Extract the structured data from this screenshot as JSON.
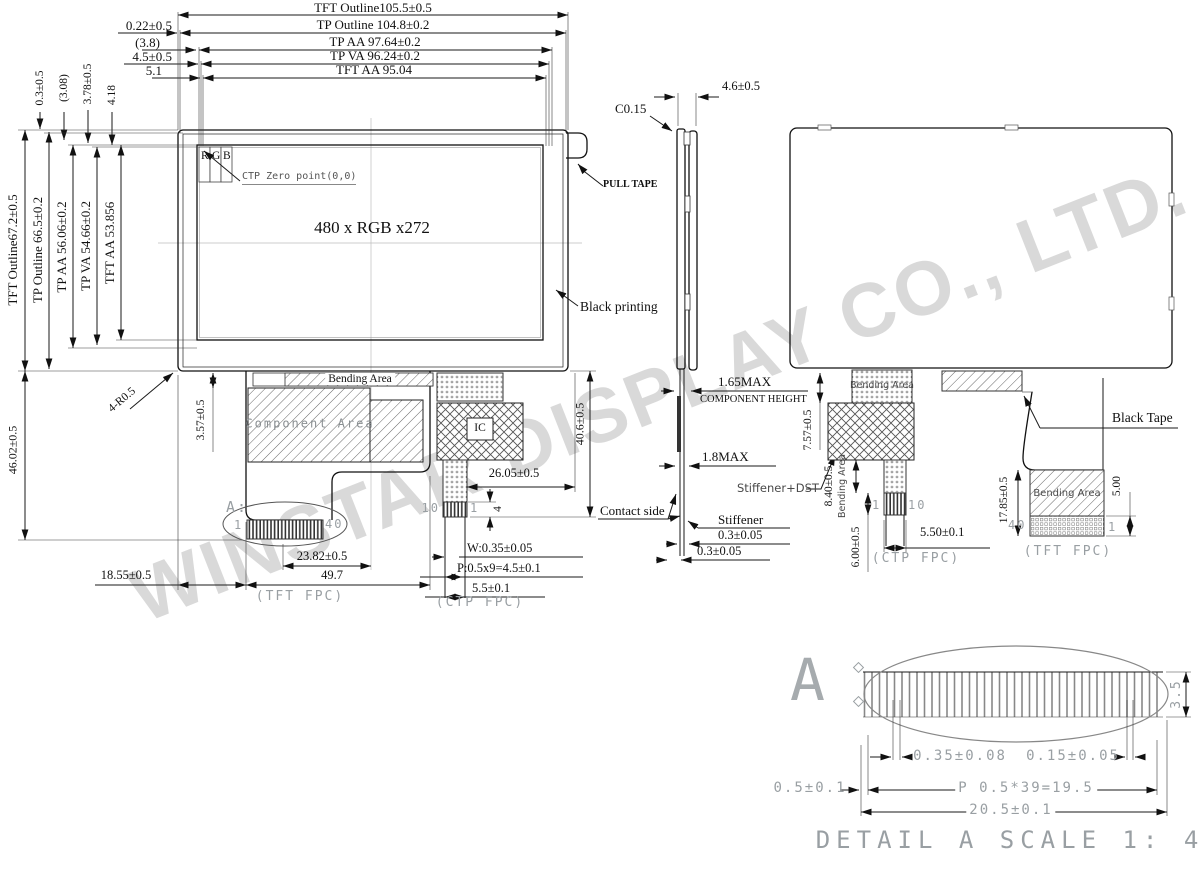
{
  "watermark": "WINSTAR DISPLAY CO., LTD.",
  "dims_top": {
    "tft_outline_w": "TFT Outline105.5±0.5",
    "tp_outline_w": "TP Outline 104.8±0.2",
    "tp_aa_w": "TP AA 97.64±0.2",
    "tp_va_w": "TP VA 96.24±0.2",
    "tft_aa_w": "TFT AA 95.04",
    "off1": "0.22±0.5",
    "off2": "(3.8)",
    "off3": "4.5±0.5",
    "off4": "5.1",
    "gap1": "0.3±0.5",
    "gap2": "(3.08)",
    "gap3": "3.78±0.5",
    "gap4": "4.18"
  },
  "dims_left": {
    "tft_outline_h": "TFT Outline67.2±0.5",
    "tp_outline_h": "TP Outline 66.5±0.2",
    "tp_aa_h": "TP AA 56.06±0.2",
    "tp_va_h": "TP VA 54.66±0.2",
    "tft_aa_h": "TFT AA 53.856"
  },
  "front": {
    "r": "R",
    "g": "G",
    "b": "B",
    "ctp_zero": "CTP Zero point(0,0)",
    "resolution": "480 x RGB x272",
    "pull_tape": "PULL TAPE",
    "black_printing": "Black printing",
    "corner_r": "4-R0.5",
    "bending_area": "Bending Area",
    "component_area": "Component Area",
    "ic": "IC",
    "comp_offset": "3.57±0.5",
    "fpc_height": "40.6±0.5",
    "ctp_offset": "26.05±0.5",
    "pin_len": "4",
    "pin10": "10",
    "pin1": "1",
    "detail_ref": "A:",
    "tft_pin1": "1",
    "tft_pin40": "40",
    "conn_center": "23.82±0.5",
    "tft_fpc_w": "49.7",
    "tft_fpc": "(TFT FPC)",
    "w_dim": "W:0.35±0.05",
    "p_dim": "P:0.5x9=4.5±0.1",
    "ctp_fpc_w": "5.5±0.1",
    "ctp_fpc": "(CTP FPC)",
    "body_h": "46.02±0.5",
    "fpc_left": "18.55±0.5"
  },
  "side": {
    "thickness": "4.6±0.5",
    "chamfer": "C0.15",
    "comp_h1": "1.65MAX",
    "comp_h2": "COMPONENT HEIGHT",
    "max_t": "1.8MAX",
    "stiffener_dst": "Stiffener+DST",
    "contact_side": "Contact side",
    "stiffener": "Stiffener",
    "t1": "0.3±0.05",
    "t2": "0.3±0.05"
  },
  "back": {
    "bending_area_ctp": "Bending Area",
    "h1": "7.57±0.5",
    "h2": "8.40±0.5",
    "bending_rot": "Bending Area",
    "h3": "6.00±0.5",
    "pin1": "1",
    "pin10": "10",
    "ctp_w": "5.50±0.1",
    "ctp_fpc": "(CTP FPC)",
    "black_tape": "Black Tape",
    "tft_h": "17.85±0.5",
    "pin40": "40",
    "pin1b": "1",
    "bending_area_tft": "Bending Area",
    "tail": "5.00",
    "tft_fpc": "(TFT FPC)"
  },
  "detail": {
    "letter": "A",
    "height": "3.5",
    "d1": "0.35±0.08",
    "d2": "0.15±0.05",
    "d3": "0.5±0.1",
    "pitch": "P 0.5*39=19.5",
    "total": "20.5±0.1",
    "title": "DETAIL A SCALE 1: 4"
  }
}
